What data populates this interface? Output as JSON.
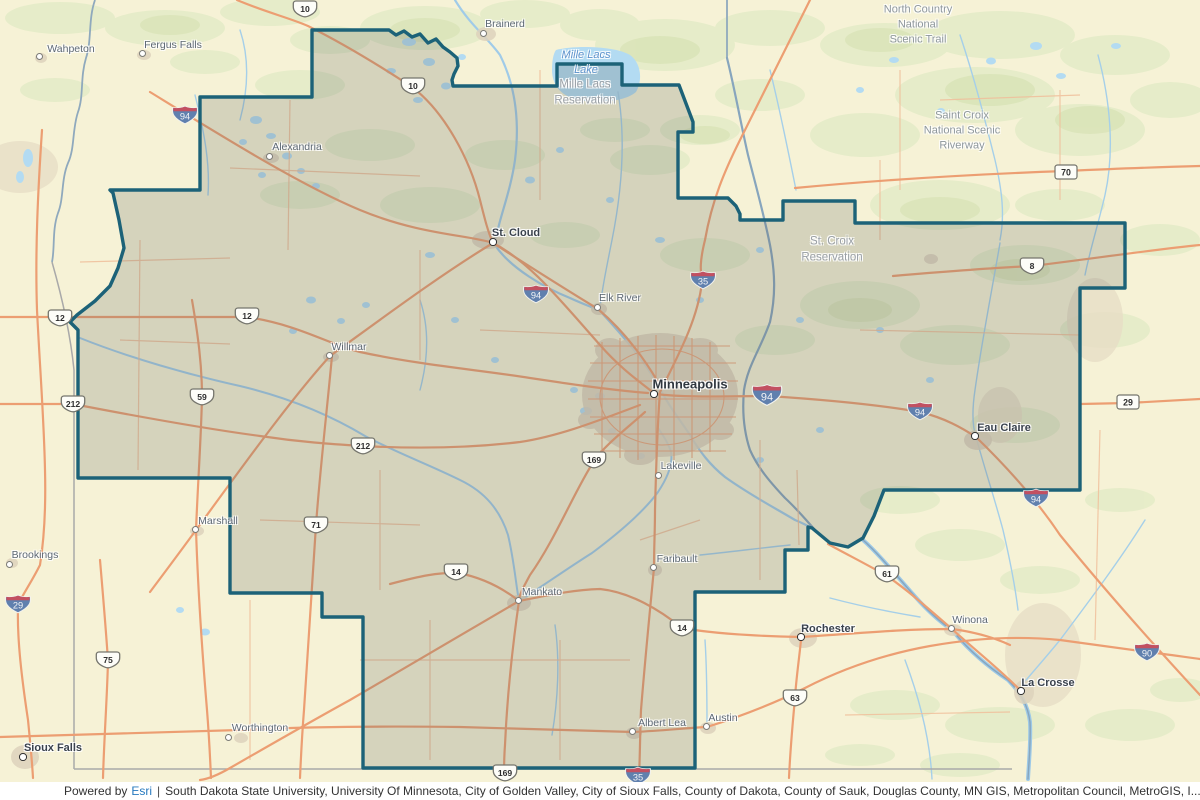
{
  "colors": {
    "boundary": "#1c6278",
    "boundary_fill": "rgba(95,100,95,0.22)",
    "water": "#a5cfe9",
    "major_road": "#ec9e72",
    "esri_link": "#2779be"
  },
  "attribution": {
    "powered_by": "Powered by",
    "esri": "Esri",
    "separator": "|",
    "sources": "South Dakota State University, University Of Minnesota, City of Golden Valley, City of Sioux Falls, County of Dakota, County of Sauk, Douglas County, MN GIS, Metropolitan Council, MetroGIS, I..."
  },
  "map": {
    "cities": [
      {
        "name": "Wahpeton",
        "x": 40,
        "y": 57,
        "label_dx": 31,
        "label_dy": -8,
        "variant": "town"
      },
      {
        "name": "Fergus Falls",
        "x": 143,
        "y": 54,
        "label_dx": 30,
        "label_dy": -9,
        "variant": "town"
      },
      {
        "name": "Brainerd",
        "x": 484,
        "y": 34,
        "label_dx": 21,
        "label_dy": -10,
        "variant": "town"
      },
      {
        "name": "Alexandria",
        "x": 270,
        "y": 157,
        "label_dx": 27,
        "label_dy": -10,
        "variant": "town"
      },
      {
        "name": "St. Cloud",
        "x": 493,
        "y": 242,
        "label_dx": 23,
        "label_dy": -9,
        "variant": "major"
      },
      {
        "name": "Elk River",
        "x": 598,
        "y": 308,
        "label_dx": 22,
        "label_dy": -10,
        "variant": "town"
      },
      {
        "name": "Willmar",
        "x": 330,
        "y": 356,
        "label_dx": 19,
        "label_dy": -9,
        "variant": "town"
      },
      {
        "name": "Minneapolis",
        "x": 654,
        "y": 394,
        "label_dx": 36,
        "label_dy": -10,
        "variant": "metro"
      },
      {
        "name": "Eau Claire",
        "x": 975,
        "y": 436,
        "label_dx": 29,
        "label_dy": -8,
        "variant": "major"
      },
      {
        "name": "Lakeville",
        "x": 659,
        "y": 476,
        "label_dx": 22,
        "label_dy": -10,
        "variant": "town"
      },
      {
        "name": "Marshall",
        "x": 196,
        "y": 530,
        "label_dx": 22,
        "label_dy": -9,
        "variant": "town"
      },
      {
        "name": "Brookings",
        "x": 10,
        "y": 565,
        "label_dx": 25,
        "label_dy": -10,
        "variant": "town"
      },
      {
        "name": "Faribault",
        "x": 654,
        "y": 568,
        "label_dx": 23,
        "label_dy": -9,
        "variant": "town"
      },
      {
        "name": "Mankato",
        "x": 519,
        "y": 601,
        "label_dx": 23,
        "label_dy": -9,
        "variant": "town"
      },
      {
        "name": "Rochester",
        "x": 801,
        "y": 637,
        "label_dx": 27,
        "label_dy": -8,
        "variant": "major"
      },
      {
        "name": "Winona",
        "x": 952,
        "y": 629,
        "label_dx": 18,
        "label_dy": -9,
        "variant": "town"
      },
      {
        "name": "La Crosse",
        "x": 1021,
        "y": 691,
        "label_dx": 27,
        "label_dy": -8,
        "variant": "major"
      },
      {
        "name": "Albert Lea",
        "x": 633,
        "y": 732,
        "label_dx": 29,
        "label_dy": -9,
        "variant": "town"
      },
      {
        "name": "Austin",
        "x": 707,
        "y": 727,
        "label_dx": 16,
        "label_dy": -9,
        "variant": "town"
      },
      {
        "name": "Worthington",
        "x": 229,
        "y": 738,
        "label_dx": 31,
        "label_dy": -10,
        "variant": "town"
      },
      {
        "name": "Sioux Falls",
        "x": 23,
        "y": 757,
        "label_dx": 30,
        "label_dy": -9,
        "variant": "major"
      }
    ],
    "area_labels": [
      {
        "text": "Mille Lacs\nLake",
        "x": 586,
        "y": 63,
        "variant": "water"
      },
      {
        "text": "Mille Lacs\nReservation",
        "x": 585,
        "y": 93,
        "variant": "area"
      },
      {
        "text": "North Country\nNational\nScenic Trail",
        "x": 918,
        "y": 25,
        "variant": "trail"
      },
      {
        "text": "Saint Croix\nNational Scenic\nRiverway",
        "x": 962,
        "y": 131,
        "variant": "trail"
      },
      {
        "text": "St. Croix\nReservation",
        "x": 832,
        "y": 250,
        "variant": "area"
      }
    ],
    "shields": [
      {
        "type": "interstate",
        "label": "94",
        "x": 185,
        "y": 115
      },
      {
        "type": "interstate",
        "label": "94",
        "x": 536,
        "y": 294
      },
      {
        "type": "interstate",
        "label": "35",
        "x": 703,
        "y": 280
      },
      {
        "type": "interstate",
        "label": "94",
        "x": 767,
        "y": 395,
        "variant": "lg"
      },
      {
        "type": "interstate",
        "label": "94",
        "x": 920,
        "y": 411
      },
      {
        "type": "interstate",
        "label": "94",
        "x": 1036,
        "y": 498
      },
      {
        "type": "interstate",
        "label": "29",
        "x": 18,
        "y": 604
      },
      {
        "type": "interstate",
        "label": "90",
        "x": 1147,
        "y": 652
      },
      {
        "type": "interstate",
        "label": "35",
        "x": 638,
        "y": 776
      },
      {
        "type": "us",
        "label": "10",
        "x": 305,
        "y": 9
      },
      {
        "type": "us",
        "label": "10",
        "x": 413,
        "y": 86
      },
      {
        "type": "us",
        "label": "12",
        "x": 60,
        "y": 318
      },
      {
        "type": "us",
        "label": "12",
        "x": 247,
        "y": 316
      },
      {
        "type": "us",
        "label": "59",
        "x": 202,
        "y": 397
      },
      {
        "type": "us",
        "label": "212",
        "x": 73,
        "y": 404
      },
      {
        "type": "us",
        "label": "212",
        "x": 363,
        "y": 446
      },
      {
        "type": "us",
        "label": "71",
        "x": 316,
        "y": 525
      },
      {
        "type": "us",
        "label": "169",
        "x": 594,
        "y": 460
      },
      {
        "type": "us",
        "label": "14",
        "x": 456,
        "y": 572
      },
      {
        "type": "us",
        "label": "14",
        "x": 682,
        "y": 628
      },
      {
        "type": "us",
        "label": "61",
        "x": 887,
        "y": 574
      },
      {
        "type": "us",
        "label": "63",
        "x": 795,
        "y": 698
      },
      {
        "type": "us",
        "label": "75",
        "x": 108,
        "y": 660
      },
      {
        "type": "us",
        "label": "8",
        "x": 1032,
        "y": 266
      },
      {
        "type": "us",
        "label": "169",
        "x": 505,
        "y": 773
      },
      {
        "type": "state",
        "label": "70",
        "x": 1066,
        "y": 172
      },
      {
        "type": "state",
        "label": "29",
        "x": 1128,
        "y": 402
      }
    ]
  }
}
